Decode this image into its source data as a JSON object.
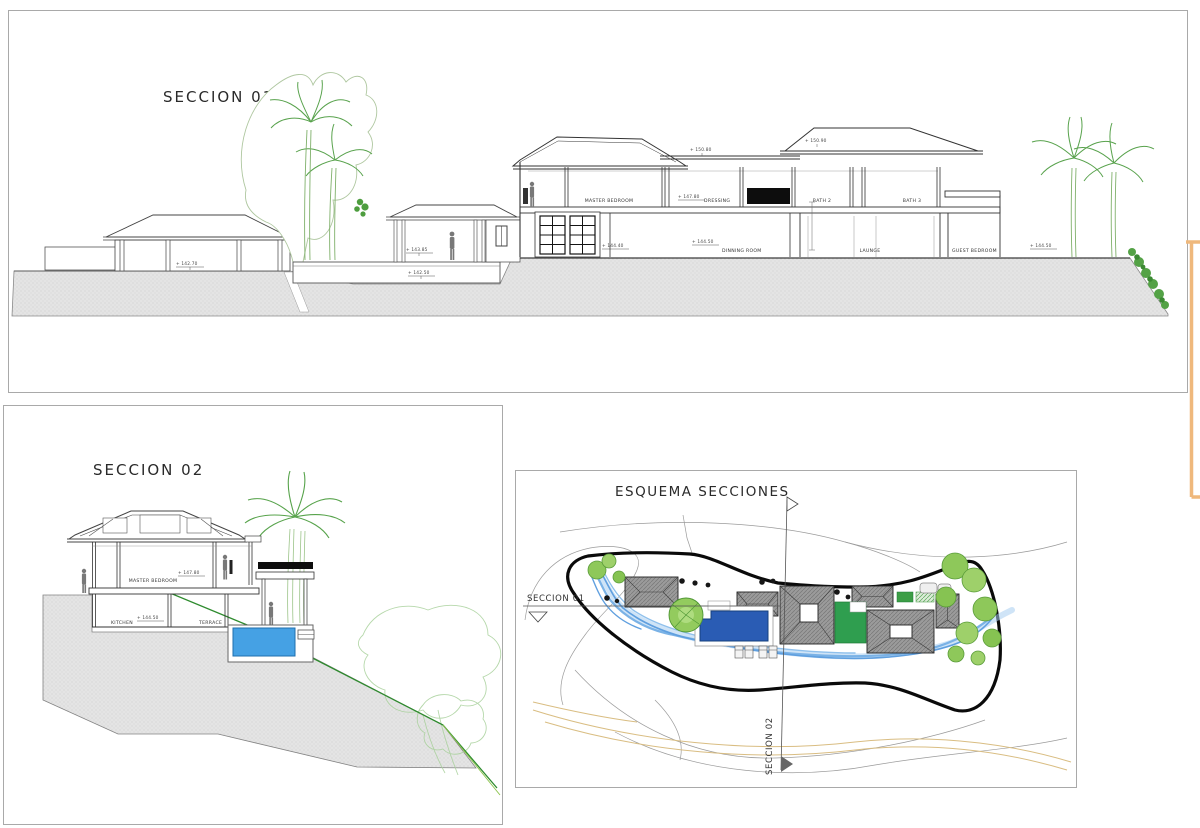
{
  "colors": {
    "pool_section": "#45a1e4",
    "pool_plan": "#2a5cb4",
    "lawn": "#2f9e4f",
    "stream": "#7ab2e6",
    "accent": "#efb87c",
    "tree": "#8ec85a",
    "boundary": "#0a0a0a"
  },
  "seccion01": {
    "title": "SECCION 01",
    "rooms": {
      "master_bedroom": "MASTER BEDROOM",
      "dressing": "DRESSING",
      "bath2": "BATH 2",
      "bath3": "BATH 3",
      "dinning": "DINNING ROOM",
      "launge": "LAUNGE",
      "guest_bedroom": "GUEST BEDROOM"
    },
    "levels": {
      "l14270": "+ 142.70",
      "l14385": "+ 143.85",
      "l14250": "+ 142.50",
      "l14780": "+ 147.80",
      "l14440": "+ 144.40",
      "l14450": "+ 144.50",
      "l15080": "+ 150.80",
      "l15090": "+ 150.90"
    }
  },
  "seccion02": {
    "title": "SECCION 02",
    "rooms": {
      "master_bedroom": "MASTER BEDROOM",
      "kitchen": "KITCHEN",
      "terrace": "TERRACE"
    },
    "levels": {
      "l14780": "+ 147.80",
      "l14450": "+ 144.50"
    }
  },
  "esquema": {
    "title": "ESQUEMA SECCIONES",
    "section01": "SECCION 01",
    "section02": "SECCION 02"
  }
}
